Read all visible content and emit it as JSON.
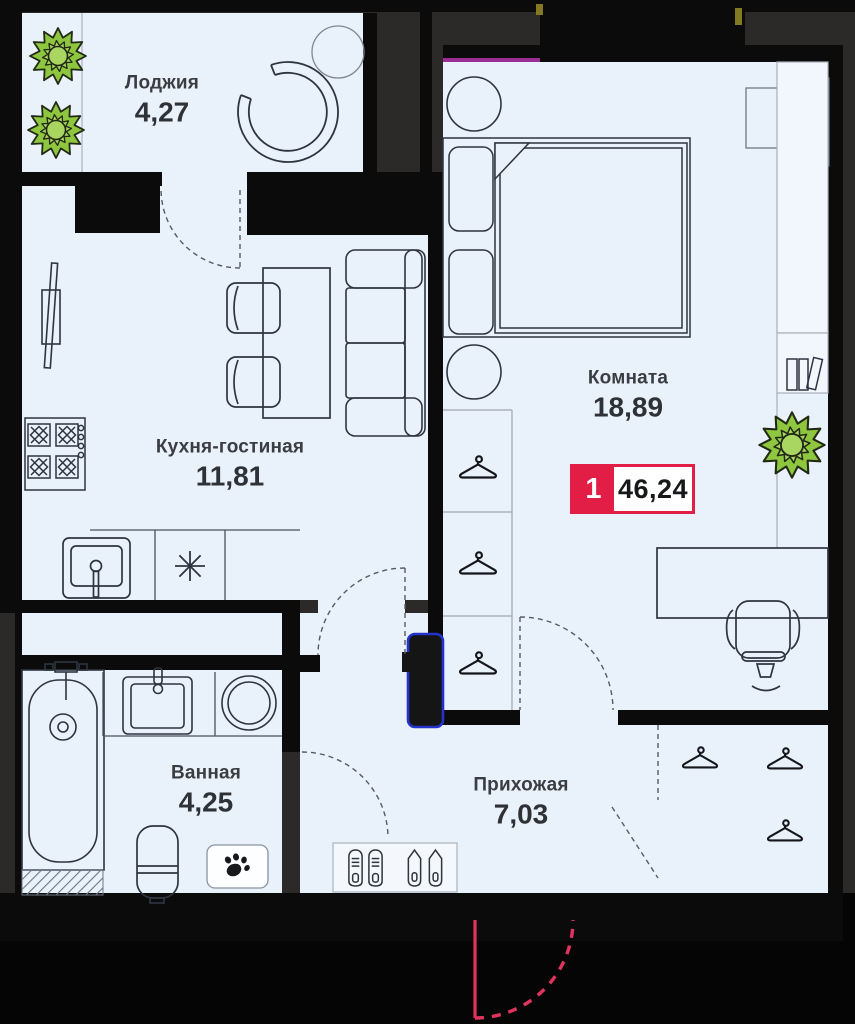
{
  "plan": {
    "badge": {
      "number": "1",
      "area": "46,24"
    },
    "rooms": {
      "loggia": {
        "name": "Лоджия",
        "area": "4,27"
      },
      "kitchen_living": {
        "name": "Кухня-гостиная",
        "area": "11,81"
      },
      "room": {
        "name": "Комната",
        "area": "18,89"
      },
      "bathroom": {
        "name": "Ванная",
        "area": "4,25"
      },
      "hallway": {
        "name": "Прихожая",
        "area": "7,03"
      }
    },
    "colors": {
      "floor": "#e9f1fa",
      "wall": "#0b0b0b",
      "outside": "#2b2a28",
      "accent_red": "#e21e46",
      "entrance_door_red": "#e0345f",
      "shaft_blue": "#2433cc",
      "plant_green": "#8ec63f",
      "window_magenta": "#9c2d96"
    }
  }
}
